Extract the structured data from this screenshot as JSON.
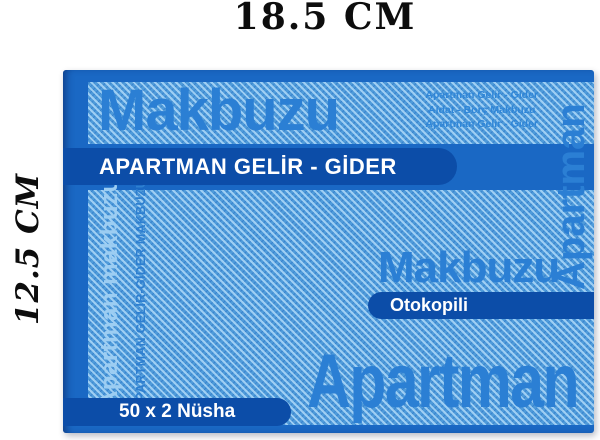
{
  "dimensions": {
    "top_label": "18.5 CM",
    "left_label": "12.5 CM"
  },
  "cover": {
    "watermark_top": "Makbuzu",
    "fine_print": [
      "Apartman Gelir - Gider",
      "Aidat - Borç Makbuzu",
      "Apartman Gelir - Gider"
    ],
    "title_banner": "APARTMAN GELİR - GİDER",
    "spine_text_large": "Apartman makbuzu",
    "spine_text_small": "APARTMAN GELİR-GİDER MAKBUZU",
    "watermark_mid": "Makbuzu",
    "otokopili_banner": "Otokopili",
    "edge_text_right": "Apartman",
    "watermark_bottom": "Apartman",
    "count_banner": "50 x 2 Nüsha",
    "colors": {
      "cover_base": "#1a68c4",
      "banner_blue": "#0c4da8",
      "pattern_blue": "#4f9bda",
      "watermark_blue": "#2b7fd4",
      "light_watermark_blue": "#9ccdf2",
      "banner_text": "#ffffff",
      "annotation_text": "#0d0d0d"
    }
  }
}
